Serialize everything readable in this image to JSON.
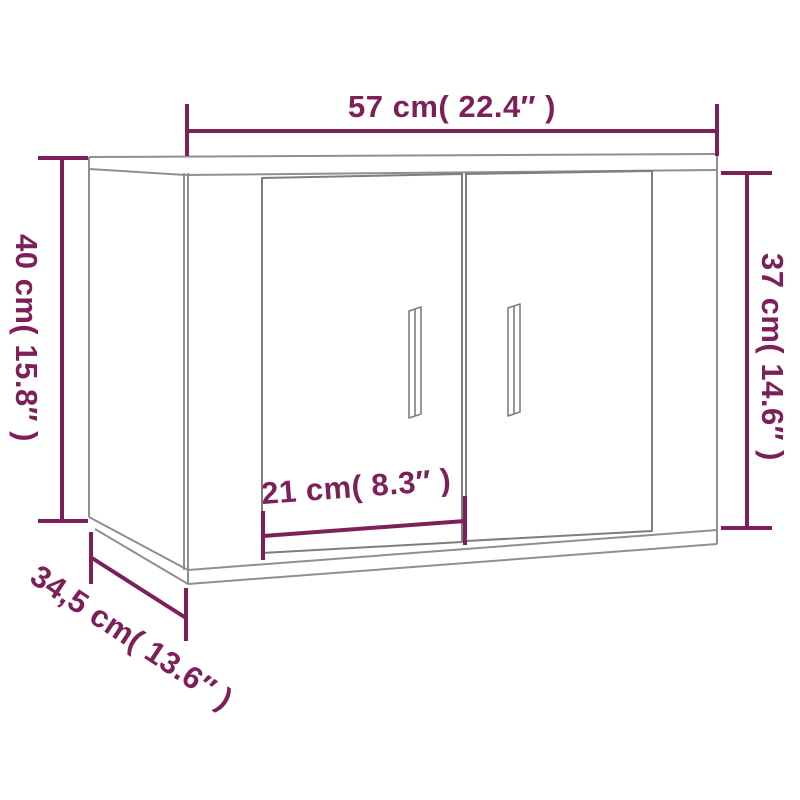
{
  "labels": {
    "width": "57 cm( 22.4″ )",
    "height_left": "40 cm( 15.8″ )",
    "height_right": "37 cm( 14.6″ )",
    "depth": "34,5 cm( 13.6″ )",
    "door_width": "21 cm( 8.3″ )"
  },
  "colors": {
    "dimension": "#7d2059",
    "cabinet_outline": "#8f8f8f",
    "door_outline": "#7e7e7e",
    "background": "#ffffff"
  }
}
